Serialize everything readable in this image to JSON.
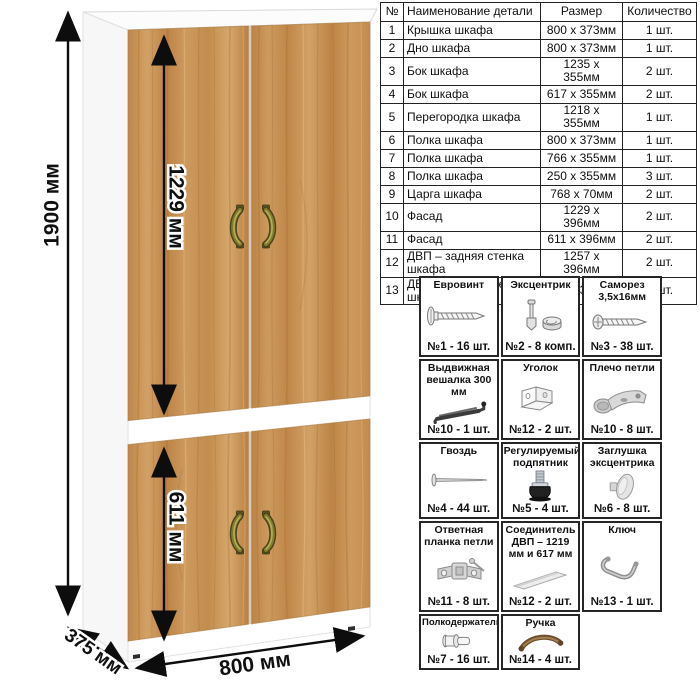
{
  "diagram": {
    "dimensions": {
      "height": "1900 мм",
      "top_door": "1229 мм",
      "bottom_door": "611 мм",
      "width": "800 мм",
      "depth": "375 мм"
    },
    "colors": {
      "wood": "#c6924f",
      "wood_dark": "#9c6a35",
      "handle_olive": "#7e7830",
      "handle_bronze": "#8a6a3f",
      "dimension_line": "#0d0d0d",
      "carcass": "#ffffff"
    }
  },
  "parts_table": {
    "headers": [
      "№",
      "Наименование детали",
      "Размер",
      "Количество"
    ],
    "rows": [
      {
        "num": "1",
        "name": "Крышка шкафа",
        "size": "800 х 373мм",
        "qty": "1 шт."
      },
      {
        "num": "2",
        "name": "Дно шкафа",
        "size": "800 х 373мм",
        "qty": "1 шт."
      },
      {
        "num": "3",
        "name": "Бок шкафа",
        "size": "1235 х 355мм",
        "qty": "2 шт."
      },
      {
        "num": "4",
        "name": "Бок шкафа",
        "size": "617 х 355мм",
        "qty": "2 шт."
      },
      {
        "num": "5",
        "name": "Перегородка шкафа",
        "size": "1218 х 355мм",
        "qty": "1 шт."
      },
      {
        "num": "6",
        "name": "Полка шкафа",
        "size": "800 х 373мм",
        "qty": "1 шт."
      },
      {
        "num": "7",
        "name": "Полка шкафа",
        "size": "766 х 355мм",
        "qty": "1 шт."
      },
      {
        "num": "8",
        "name": "Полка шкафа",
        "size": "250 х 355мм",
        "qty": "3 шт."
      },
      {
        "num": "9",
        "name": "Царга шкафа",
        "size": "768 х 70мм",
        "qty": "2 шт."
      },
      {
        "num": "10",
        "name": "Фасад",
        "size": "1229 х 396мм",
        "qty": "2 шт."
      },
      {
        "num": "11",
        "name": "Фасад",
        "size": "611 х 396мм",
        "qty": "2 шт."
      },
      {
        "num": "12",
        "name": "ДВП – задняя стенка шкафа",
        "size": "1257 х 396мм",
        "qty": "2 шт."
      },
      {
        "num": "13",
        "name": "ДВП – задняя стенка шкафа",
        "size": "639 х 396мм",
        "qty": "2 шт."
      }
    ]
  },
  "hardware": {
    "items": [
      {
        "name": "Евровинт",
        "qty": "№1 - 16 шт.",
        "icon": "confirmat-screw-icon"
      },
      {
        "name": "Эксцентрик",
        "qty": "№2 - 8 комп.",
        "icon": "cam-lock-icon"
      },
      {
        "name": "Саморез 3,5х16мм",
        "qty": "№3 - 38 шт.",
        "icon": "screw-icon"
      },
      {
        "name": "Выдвижная вешалка 300 мм",
        "qty": "№10 - 1 шт.",
        "icon": "pullout-hanger-icon"
      },
      {
        "name": "Уголок",
        "qty": "№12 - 2 шт.",
        "icon": "corner-bracket-icon"
      },
      {
        "name": "Плечо петли",
        "qty": "№10 - 8 шт.",
        "icon": "hinge-arm-icon"
      },
      {
        "name": "Гвоздь",
        "qty": "№4 - 44 шт.",
        "icon": "nail-icon"
      },
      {
        "name": "Регулируемый подпятник",
        "qty": "№5 - 4 шт.",
        "icon": "adjustable-foot-icon"
      },
      {
        "name": "Заглушка эксцентрика",
        "qty": "№6 - 8 шт.",
        "icon": "cam-cover-icon"
      },
      {
        "name": "Ответная планка петли",
        "qty": "№11 - 8 шт.",
        "icon": "hinge-plate-icon"
      },
      {
        "name": "Соединитель ДВП – 1219 мм и 617 мм",
        "qty": "№12 - 2 шт.",
        "icon": "hdf-connector-icon"
      },
      {
        "name": "Ключ",
        "qty": "№13 - 1 шт.",
        "icon": "hex-key-icon"
      },
      {
        "name": "Полкодержатель",
        "qty": "№7 - 16 шт.",
        "icon": "shelf-pin-icon"
      },
      {
        "name": "Ручка",
        "qty": "№14 - 4 шт.",
        "icon": "handle-icon"
      }
    ]
  }
}
